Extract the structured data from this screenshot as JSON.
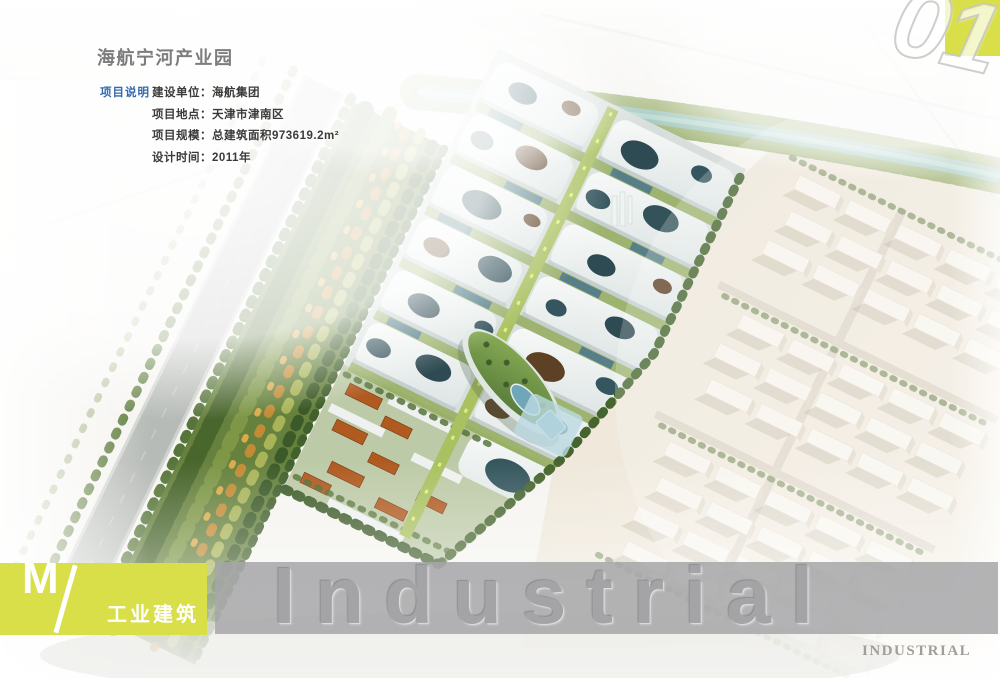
{
  "header": {
    "title": "海航宁河产业园"
  },
  "project_info": {
    "section_label": "项目说明",
    "items": [
      {
        "label": "建设单位：",
        "value": "海航集团"
      },
      {
        "label": "项目地点：",
        "value": "天津市津南区"
      },
      {
        "label": "项目规模：",
        "value": "总建筑面积973619.2m²"
      },
      {
        "label": "设计时间：",
        "value": "2011年"
      }
    ]
  },
  "page_number": "01",
  "category_badge": {
    "letter": "M",
    "label": "工业建筑"
  },
  "watermark": {
    "band_text": "Industrial"
  },
  "footer": {
    "text": "INDUSTRIAL"
  },
  "colors": {
    "accent_yellow": "#d8df49",
    "label_blue": "#3269ae",
    "band_gray": "#a6a6a9"
  }
}
